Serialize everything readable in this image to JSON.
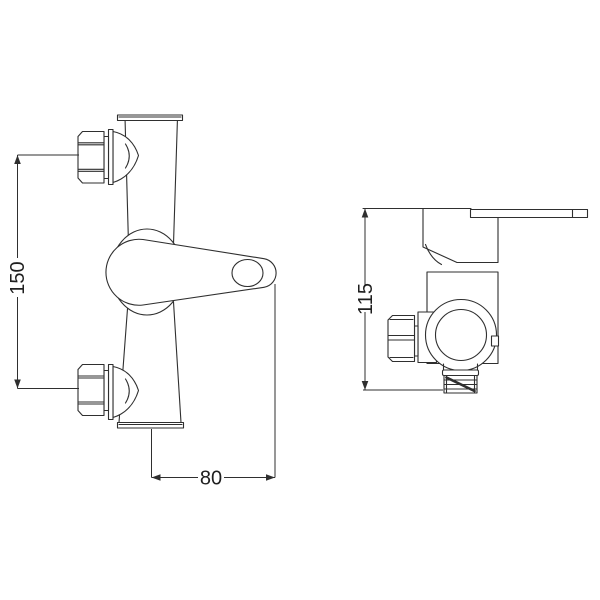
{
  "drawing": {
    "background": "#ffffff",
    "line_color": "#2f2f2f",
    "text_color": "#1f1f1f",
    "dimensions": {
      "inlet_spacing": {
        "label": "150"
      },
      "handle_width": {
        "label": "80"
      },
      "body_height": {
        "label": "115"
      }
    }
  }
}
